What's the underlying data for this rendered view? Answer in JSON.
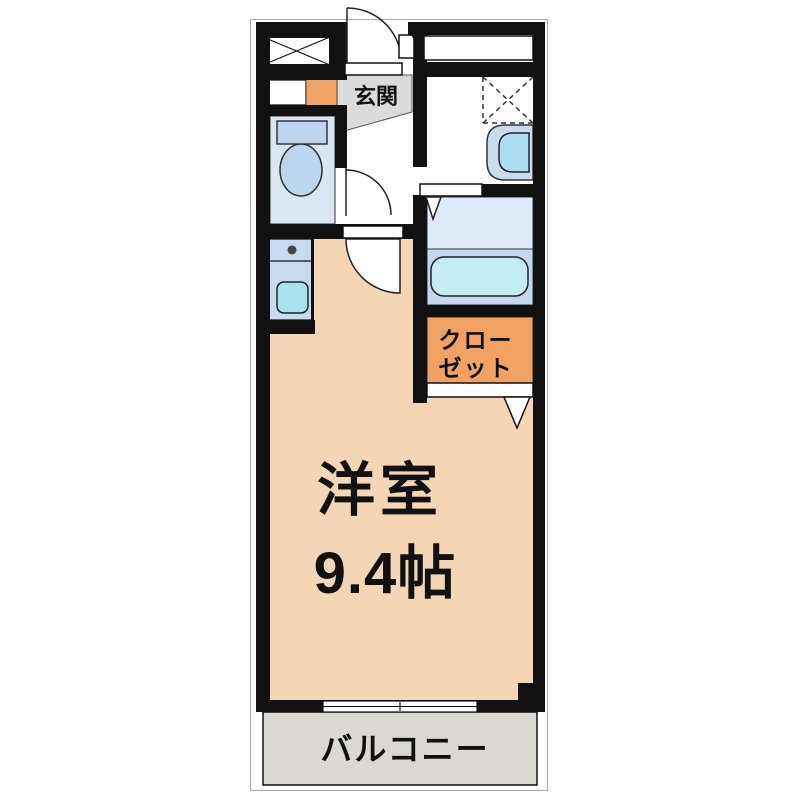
{
  "floorplan": {
    "labels": {
      "genkan": "玄関",
      "closet_line1": "クロー",
      "closet_line2": "ゼット",
      "room_name": "洋室",
      "room_size": "9.4帖",
      "balcony": "バルコニー"
    },
    "colors": {
      "wall": "#111111",
      "room_floor": "#F4D5B5",
      "genkan_floor": "#DBDBDB",
      "closet": "#F0A263",
      "entry_step": "#F0A263",
      "toilet_floor": "#D9E7F5",
      "fixture_blue": "#BCD6F0",
      "kitchen_counter": "#C6DBF1",
      "sink": "#A9E2EC",
      "bath_floor_upper": "#DFEAF8",
      "bath_floor_lower": "#C5D7EE",
      "bathtub": "#C3ECF4",
      "basin_outer": "#C9DCEF",
      "basin_bowl": "#ADDCF2",
      "balcony_floor": "#DBD7D2"
    }
  }
}
